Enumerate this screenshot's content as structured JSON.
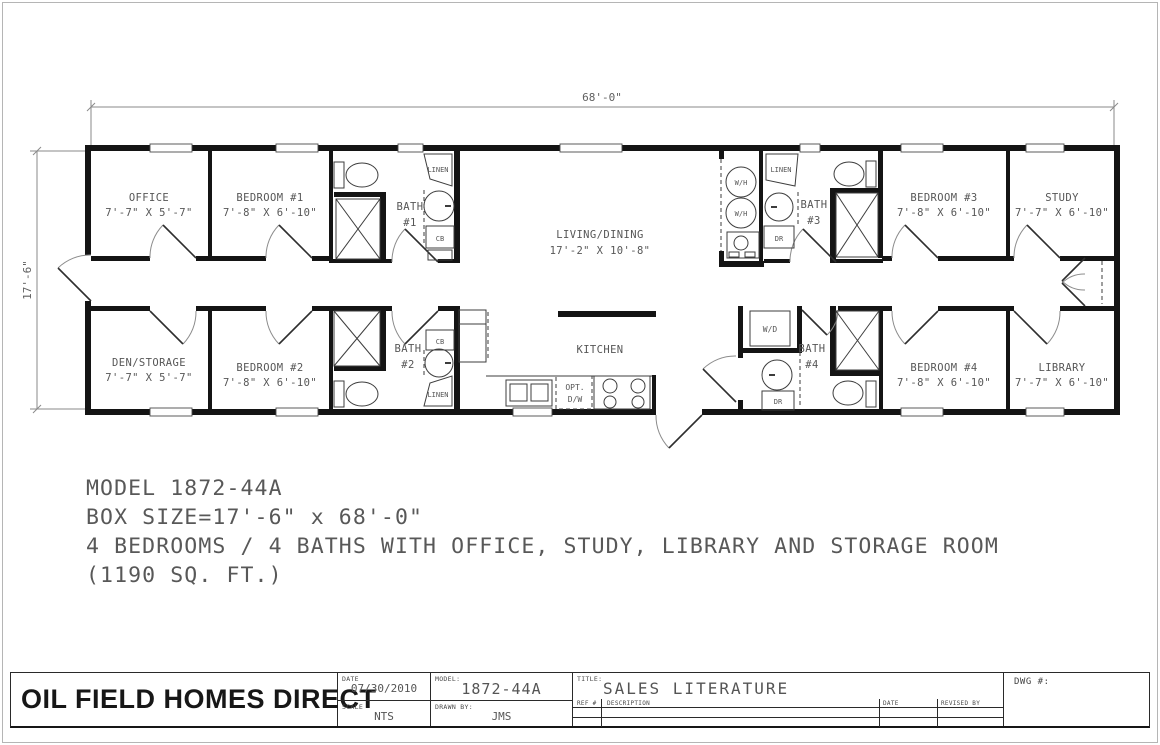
{
  "drawing": {
    "dim_width": "68'-0\"",
    "dim_height": "17'-6\"",
    "rooms": {
      "office": {
        "name": "OFFICE",
        "dims": "7'-7\" X 5'-7\""
      },
      "bedroom1": {
        "name": "BEDROOM #1",
        "dims": "7'-8\" X 6'-10\""
      },
      "bath1": {
        "name": "BATH",
        "num": "#1"
      },
      "living": {
        "name": "LIVING/DINING",
        "dims": "17'-2\" X 10'-8\""
      },
      "bedroom3": {
        "name": "BEDROOM #3",
        "dims": "7'-8\" X 6'-10\""
      },
      "study": {
        "name": "STUDY",
        "dims": "7'-7\" X 6'-10\""
      },
      "bath3": {
        "name": "BATH",
        "num": "#3"
      },
      "den": {
        "name": "DEN/STORAGE",
        "dims": "7'-7\" X 5'-7\""
      },
      "bedroom2": {
        "name": "BEDROOM #2",
        "dims": "7'-8\" X 6'-10\""
      },
      "bath2": {
        "name": "BATH",
        "num": "#2"
      },
      "kitchen": {
        "name": "KITCHEN"
      },
      "bath4": {
        "name": "BATH",
        "num": "#4"
      },
      "bedroom4": {
        "name": "BEDROOM #4",
        "dims": "7'-8\" X 6'-10\""
      },
      "library": {
        "name": "LIBRARY",
        "dims": "7'-7\" X 6'-10\""
      }
    },
    "fixtures": {
      "linen": "LINEN",
      "cb": "CB",
      "dr": "DR",
      "wh": "W/H",
      "wd": "W/D",
      "opt": "OPT.",
      "dw": "D/W"
    }
  },
  "notes": {
    "line1": "MODEL 1872-44A",
    "line2": "BOX SIZE=17'-6\" x 68'-0\"",
    "line3": "4 BEDROOMS / 4 BATHS WITH OFFICE, STUDY, LIBRARY AND STORAGE ROOM",
    "line4": "(1190 SQ. FT.)"
  },
  "title_block": {
    "company": "OIL FIELD HOMES DIRECT",
    "date_label": "DATE",
    "date": "07/30/2010",
    "scale_label": "SCALE",
    "scale": "NTS",
    "model_label": "MODEL:",
    "model": "1872-44A",
    "drawn_by_label": "DRAWN BY:",
    "drawn_by": "JMS",
    "title_label": "TITLE:",
    "title": "SALES LITERATURE",
    "ref_label": "REF #",
    "description_label": "DESCRIPTION",
    "rev_date_label": "DATE",
    "revised_by_label": "REVISED BY",
    "dwg_label": "DWG #:"
  },
  "colors": {
    "wall": "#141414",
    "line": "#3d3d3d",
    "text": "#565656"
  }
}
